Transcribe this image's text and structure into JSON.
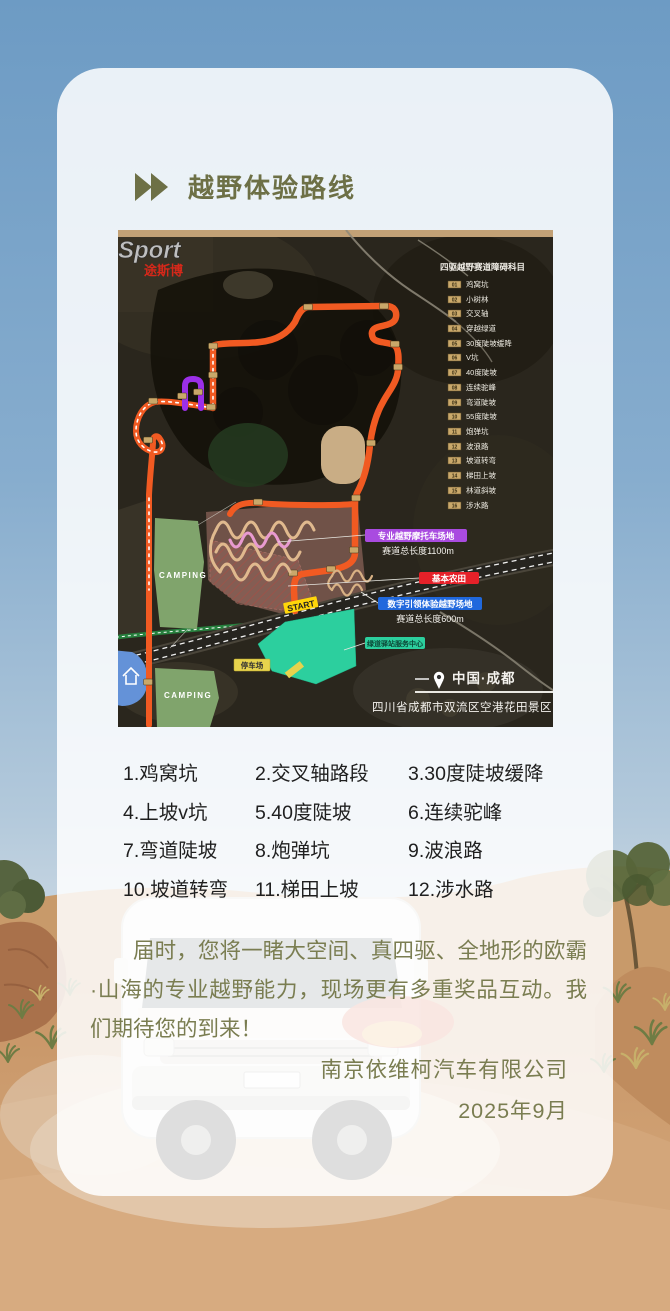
{
  "title": {
    "label": "越野体验路线"
  },
  "map": {
    "logo_line1": "Sport",
    "logo_line2": "途斯博",
    "legend_title": "四驱越野赛道障碍科目",
    "legend": [
      {
        "num": "01",
        "label": "鸡窝坑"
      },
      {
        "num": "02",
        "label": "小树林"
      },
      {
        "num": "03",
        "label": "交叉轴"
      },
      {
        "num": "04",
        "label": "穿越绿道"
      },
      {
        "num": "05",
        "label": "30度陡坡缓降"
      },
      {
        "num": "06",
        "label": "V坑"
      },
      {
        "num": "07",
        "label": "40度陡坡"
      },
      {
        "num": "08",
        "label": "连续驼峰"
      },
      {
        "num": "09",
        "label": "弯道陡坡"
      },
      {
        "num": "10",
        "label": "55度陡坡"
      },
      {
        "num": "11",
        "label": "炮弹坑"
      },
      {
        "num": "12",
        "label": "波浪路"
      },
      {
        "num": "13",
        "label": "坡道转弯"
      },
      {
        "num": "14",
        "label": "梯田上坡"
      },
      {
        "num": "15",
        "label": "林道斜坡"
      },
      {
        "num": "16",
        "label": "涉水路"
      }
    ],
    "labels": {
      "moto_area": "专业越野摩托车场地",
      "moto_length": "赛道总长度1100m",
      "farmland": "基本农田",
      "digital_area": "数字引领体验越野场地",
      "digital_length": "赛道总长度600m",
      "greenway_station": "绿道驿站服务中心",
      "parking": "停车场",
      "start": "START",
      "camping_upper": "CAMPING",
      "camping_lower": "CAMPING"
    },
    "location_city": "中国·成都",
    "location_address": "四川省成都市双流区空港花田景区"
  },
  "obstacles": [
    "1.鸡窝坑",
    "2.交叉轴路段",
    "3.30度陡坡缓降",
    "4.上坡v坑",
    "5.40度陡坡",
    "6.连续驼峰",
    "7.弯道陡坡",
    "8.炮弹坑",
    "9.波浪路",
    "10.坡道转弯",
    "11.梯田上坡",
    "12.涉水路"
  ],
  "paragraph": "届时，您将一睹大空间、真四驱、全地形的欧霸·山海的专业越野能力，现场更有多重奖品互动。我们期待您的到来！",
  "signature": {
    "company": "南京依维柯汽车有限公司",
    "date": "2025年9月"
  },
  "colors": {
    "accent_olive": "#6d7046",
    "body_olive": "#7a7d51",
    "route_orange": "#f15a22",
    "text_dark": "#1f1f1f",
    "sky_blue": "#6d9bc4",
    "sand": "#c9996b",
    "camping_green": "#80a46c",
    "teal": "#2ccf9e",
    "pill_purple": "#a94be0",
    "pill_red": "#e62129",
    "pill_blue": "#2068dd"
  }
}
